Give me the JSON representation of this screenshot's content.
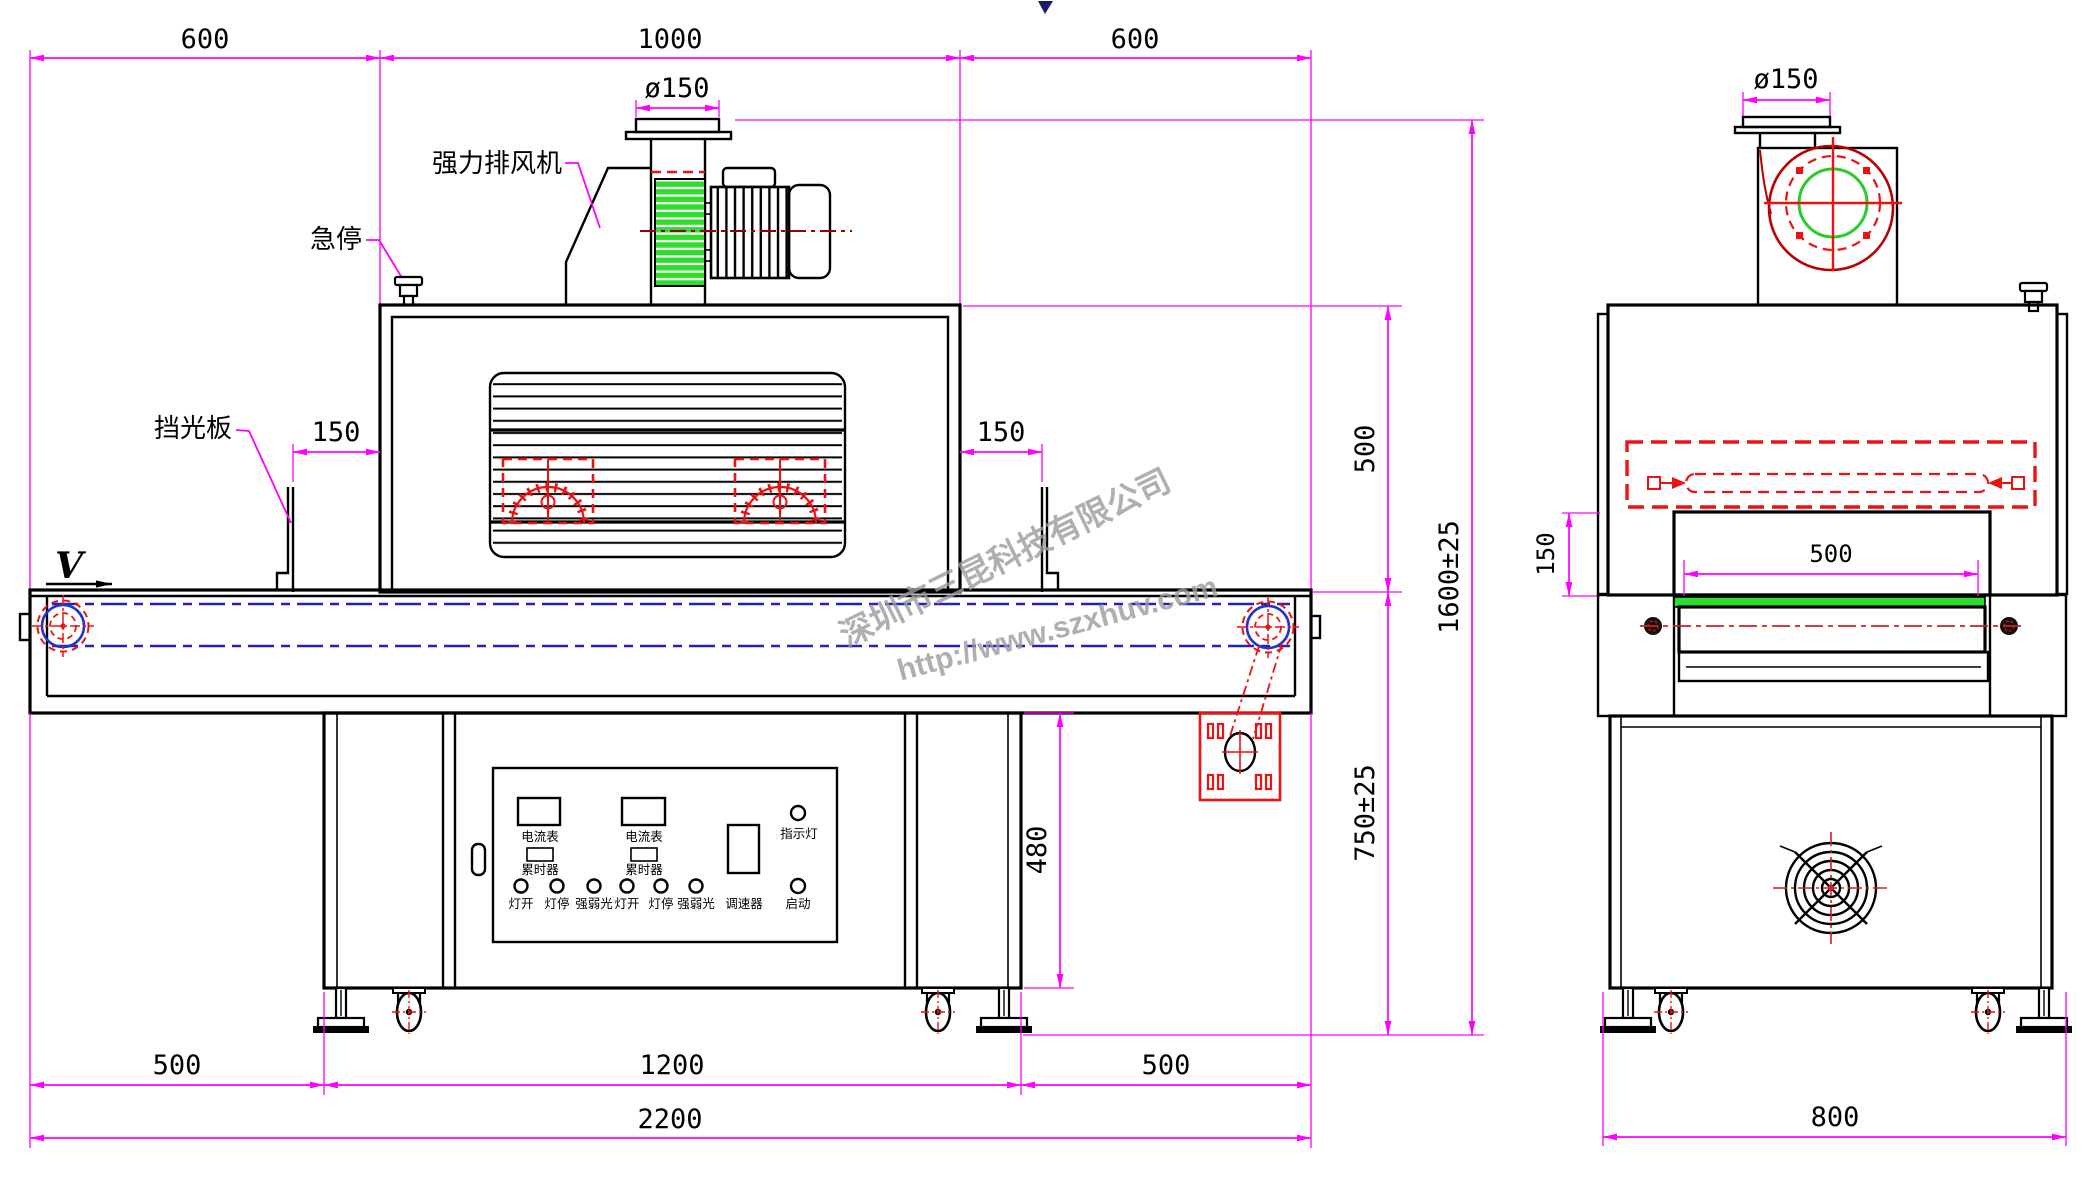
{
  "watermark": {
    "company": "深圳市三昆科技有限公司",
    "url": "http://www.szxhuv.com"
  },
  "callouts": {
    "exhaust_fan": "强力排风机",
    "emergency_stop": "急停",
    "light_shield": "挡光板",
    "belt_direction": "V"
  },
  "dimensions": {
    "top_left": "600",
    "top_mid": "1000",
    "top_right": "600",
    "duct_dia_front": "ø150",
    "duct_dia_side": "ø150",
    "shield_left": "150",
    "shield_right": "150",
    "oven_to_belt": "500",
    "total_height": "1600±25",
    "belt_height": "750±25",
    "stand_height": "480",
    "bottom_left": "500",
    "bottom_mid": "1200",
    "bottom_right": "500",
    "total_length": "2200",
    "side_opening": "500",
    "side_lamp_to_belt": "150",
    "side_width": "800"
  },
  "panel": {
    "meter_left": "电流表",
    "meter_right": "电流表",
    "timer_left": "累时器",
    "timer_right": "累时器",
    "speed_controller": "调速器",
    "indicator": "指示灯",
    "start": "启动",
    "buttons": [
      "灯开",
      "灯停",
      "强弱光",
      "灯开",
      "灯停",
      "强弱光"
    ]
  }
}
